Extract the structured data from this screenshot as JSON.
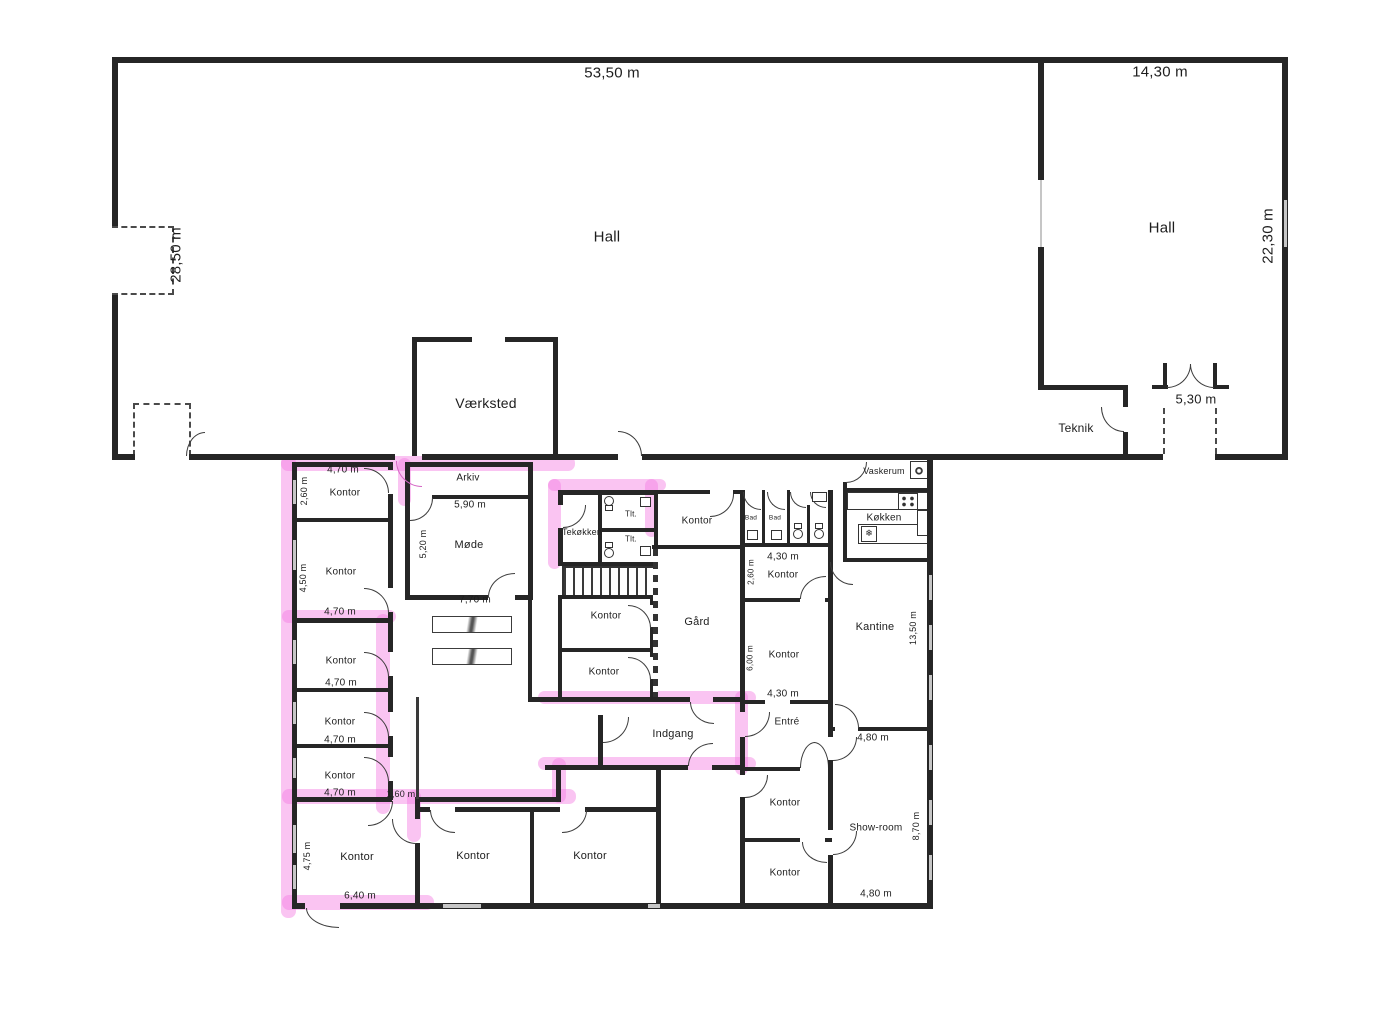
{
  "plan": {
    "hall1": {
      "name": "Hall",
      "dim_w": "53,50 m",
      "dim_h": "28,50 m"
    },
    "hall2": {
      "name": "Hall",
      "dim_w": "14,30 m",
      "dim_h": "22,30 m",
      "door": "5,30 m"
    },
    "vaerksted": {
      "name": "Værksted"
    },
    "teknik": {
      "name": "Teknik"
    },
    "lc": {
      "r1": {
        "name": "Kontor",
        "w": "4,70 m",
        "h": "2,60 m"
      },
      "r2": {
        "name": "Kontor",
        "h": "4,50 m",
        "w": "4,70 m"
      },
      "r3": {
        "name": "Kontor",
        "w": "4,70 m"
      },
      "r4": {
        "name": "Kontor",
        "w": "4,70 m"
      },
      "r5": {
        "name": "Kontor",
        "w": "4,70 m"
      },
      "gap": "1,60 m",
      "r6": {
        "name": "Kontor",
        "h": "4,75 m",
        "w": "6,40 m"
      }
    },
    "mid": {
      "arkiv": {
        "name": "Arkiv",
        "w": "5,90 m"
      },
      "moede": {
        "name": "Møde",
        "h": "5,20 m",
        "w": "7,70 m"
      },
      "tek": "Tekøkken",
      "tlt1": "Tlt.",
      "tlt2": "Tlt.",
      "ktop": "Kontor",
      "k1": "Kontor",
      "k2": "Kontor",
      "gaard": "Gård",
      "indgang": "Indgang",
      "kb1": "Kontor",
      "kb2": "Kontor"
    },
    "rc": {
      "bad1": "Bad",
      "bad2": "Bad",
      "kt": {
        "name": "Kontor",
        "w": "4,30 m",
        "h": "2,60 m"
      },
      "km": {
        "name": "Kontor",
        "h": "6,00 m",
        "w": "4,30 m"
      },
      "entre": "Entré",
      "kb1": "Kontor",
      "kb2": "Kontor"
    },
    "fr": {
      "vask": "Vaskerum",
      "kok": "Køkken",
      "kantine": {
        "name": "Kantine",
        "h": "13,50 m",
        "w": "4,80 m"
      },
      "show": {
        "name": "Show-room",
        "h": "8,70 m",
        "w": "4,80 m"
      }
    }
  },
  "icons": {
    "freezer": "❄"
  },
  "colors": {
    "wall": "#262626",
    "highlight": "#f37ce2",
    "window": "#c6c6c6"
  }
}
